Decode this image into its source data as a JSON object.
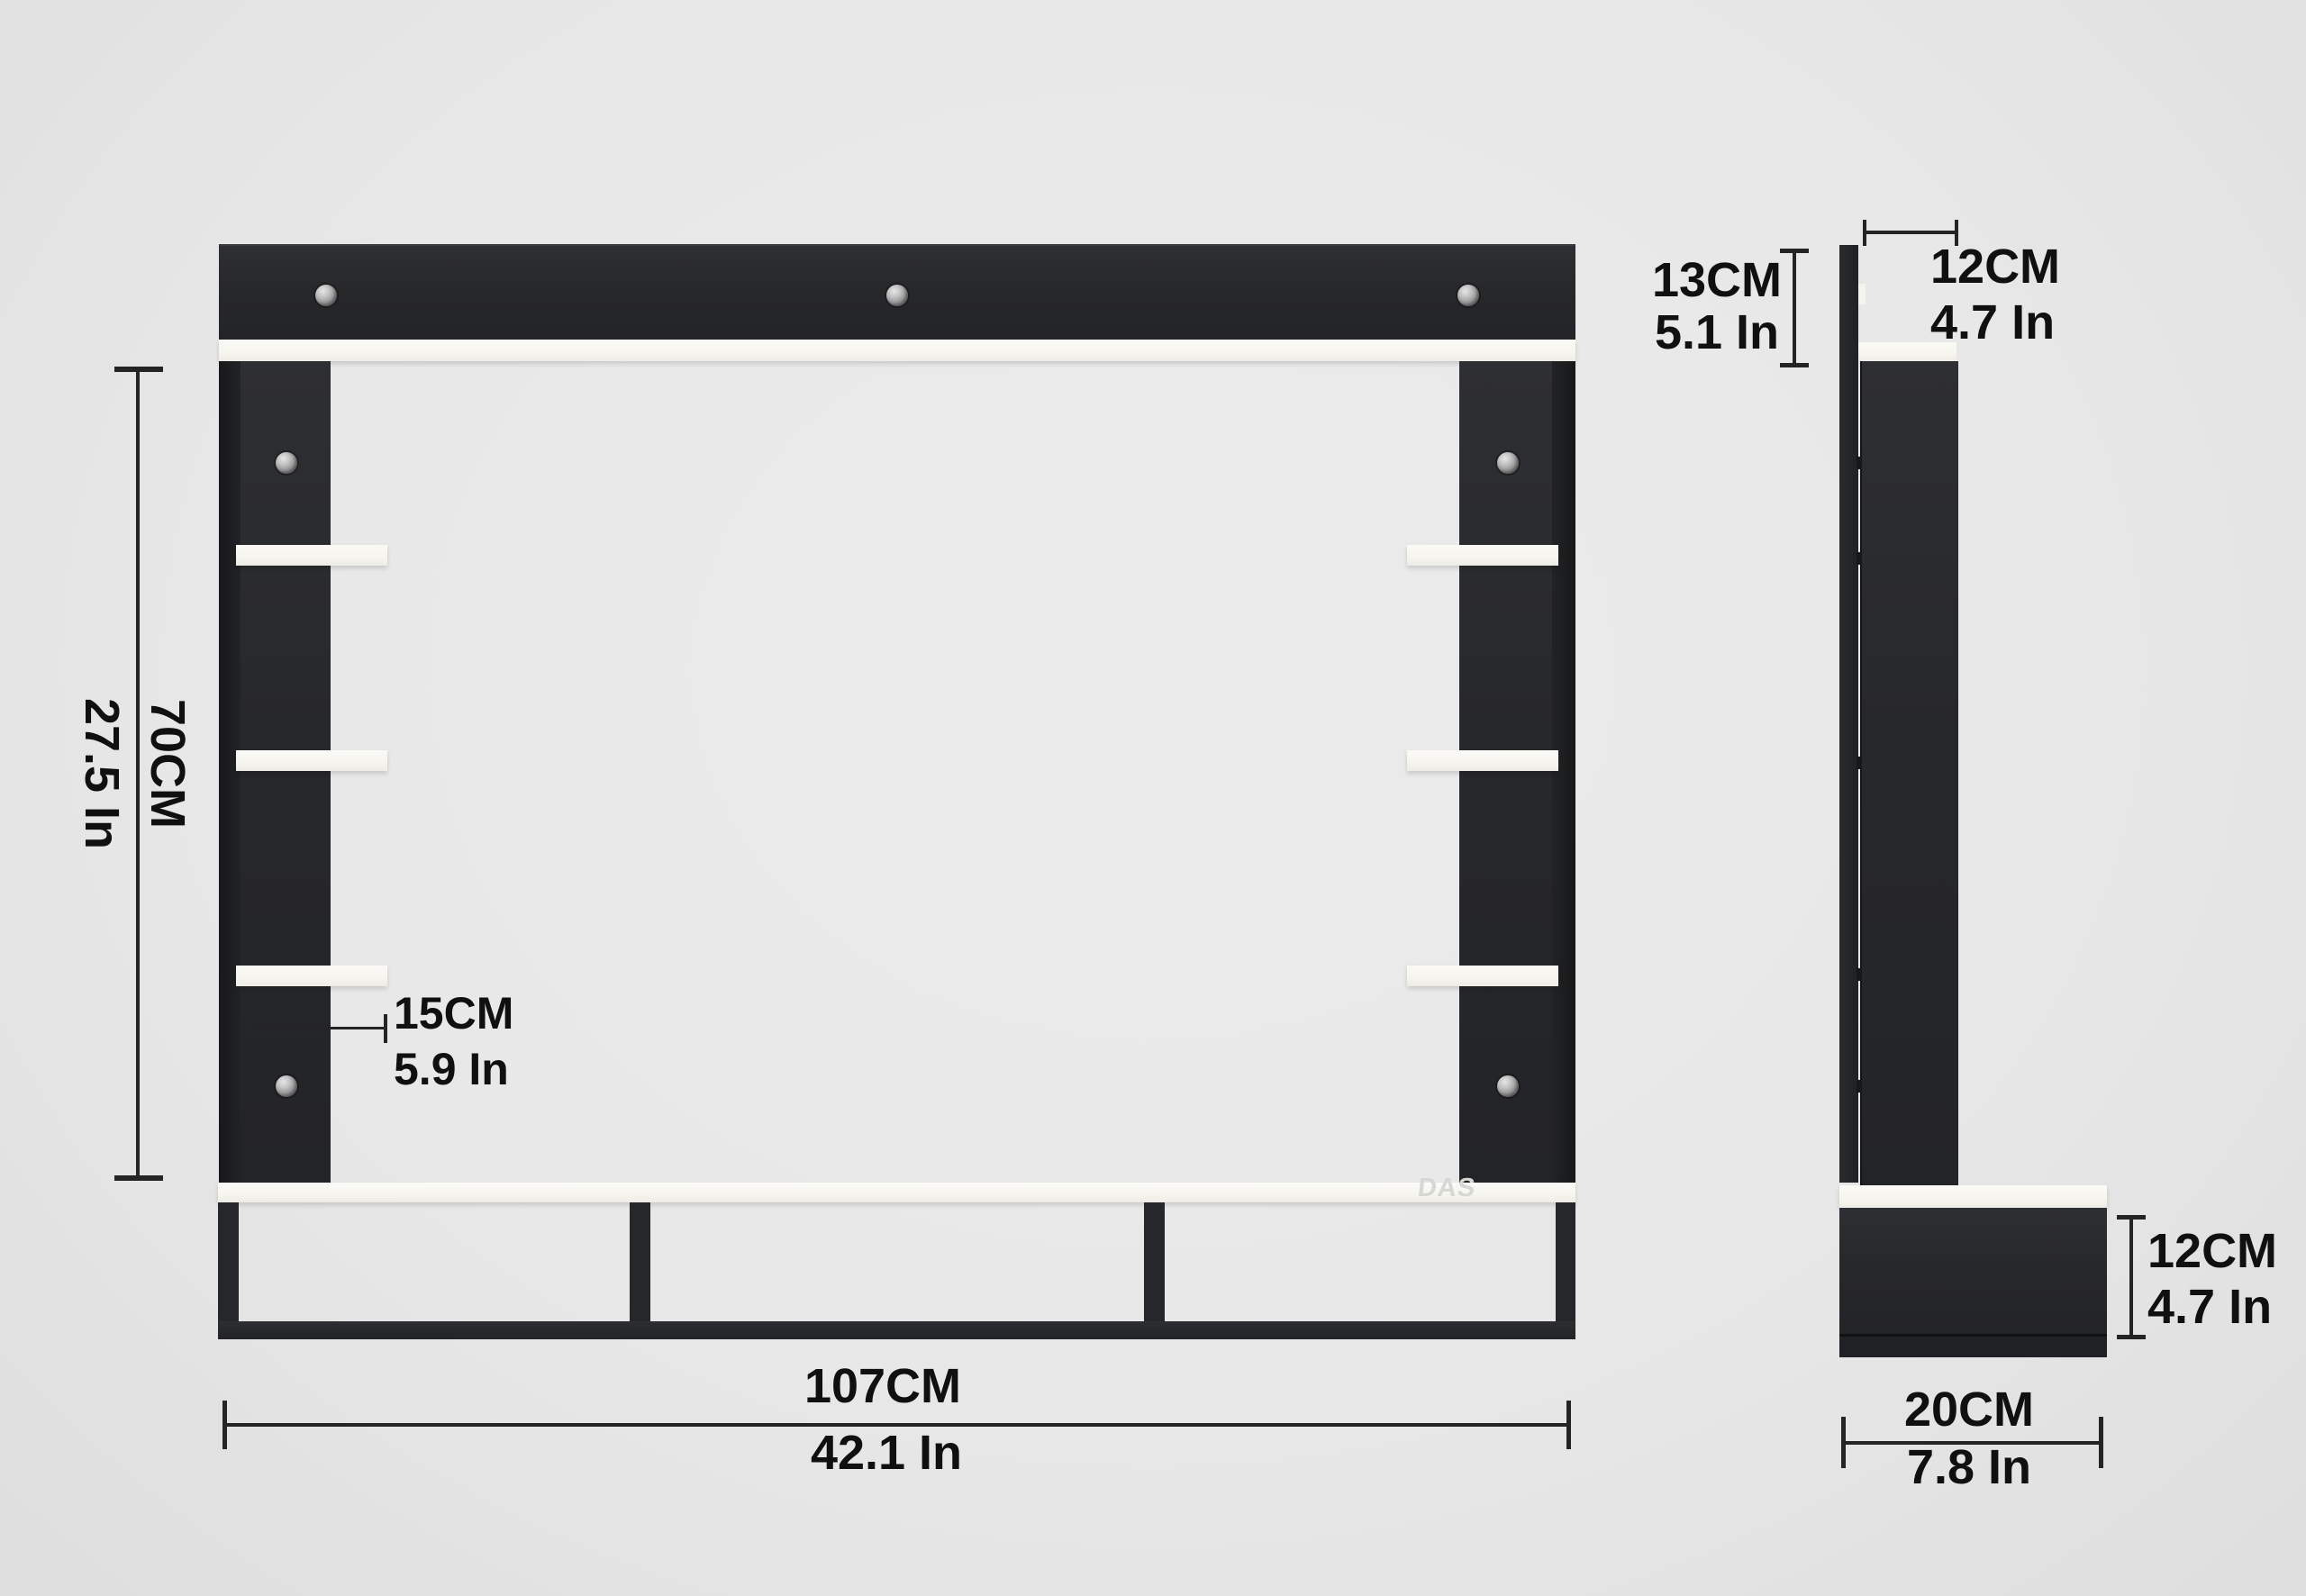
{
  "diagram_title": "TV wall unit dimension diagram",
  "labels": {
    "height": {
      "cm": "70CM",
      "inch": "27.5 In"
    },
    "width": {
      "cm": "107CM",
      "inch": "42.1 In"
    },
    "shelf_depth": {
      "cm": "15CM",
      "inch": "5.9 In"
    },
    "top_overhang": {
      "cm": "13CM",
      "inch": "5.1 In"
    },
    "top_shelf_depth": {
      "cm": "12CM",
      "inch": "4.7 In"
    },
    "base_height": {
      "cm": "12CM",
      "inch": "4.7 In"
    },
    "base_depth": {
      "cm": "20CM",
      "inch": "7.8 In"
    }
  },
  "watermark": "DAS",
  "colors": {
    "background": "#e8e8e8",
    "unit_dark": "#27282a",
    "shelf_white": "#f6f5ef",
    "dimension_text": "#111111",
    "watermark_gray": "#d7d7d3",
    "screw_silver": "#b5b5b5"
  }
}
